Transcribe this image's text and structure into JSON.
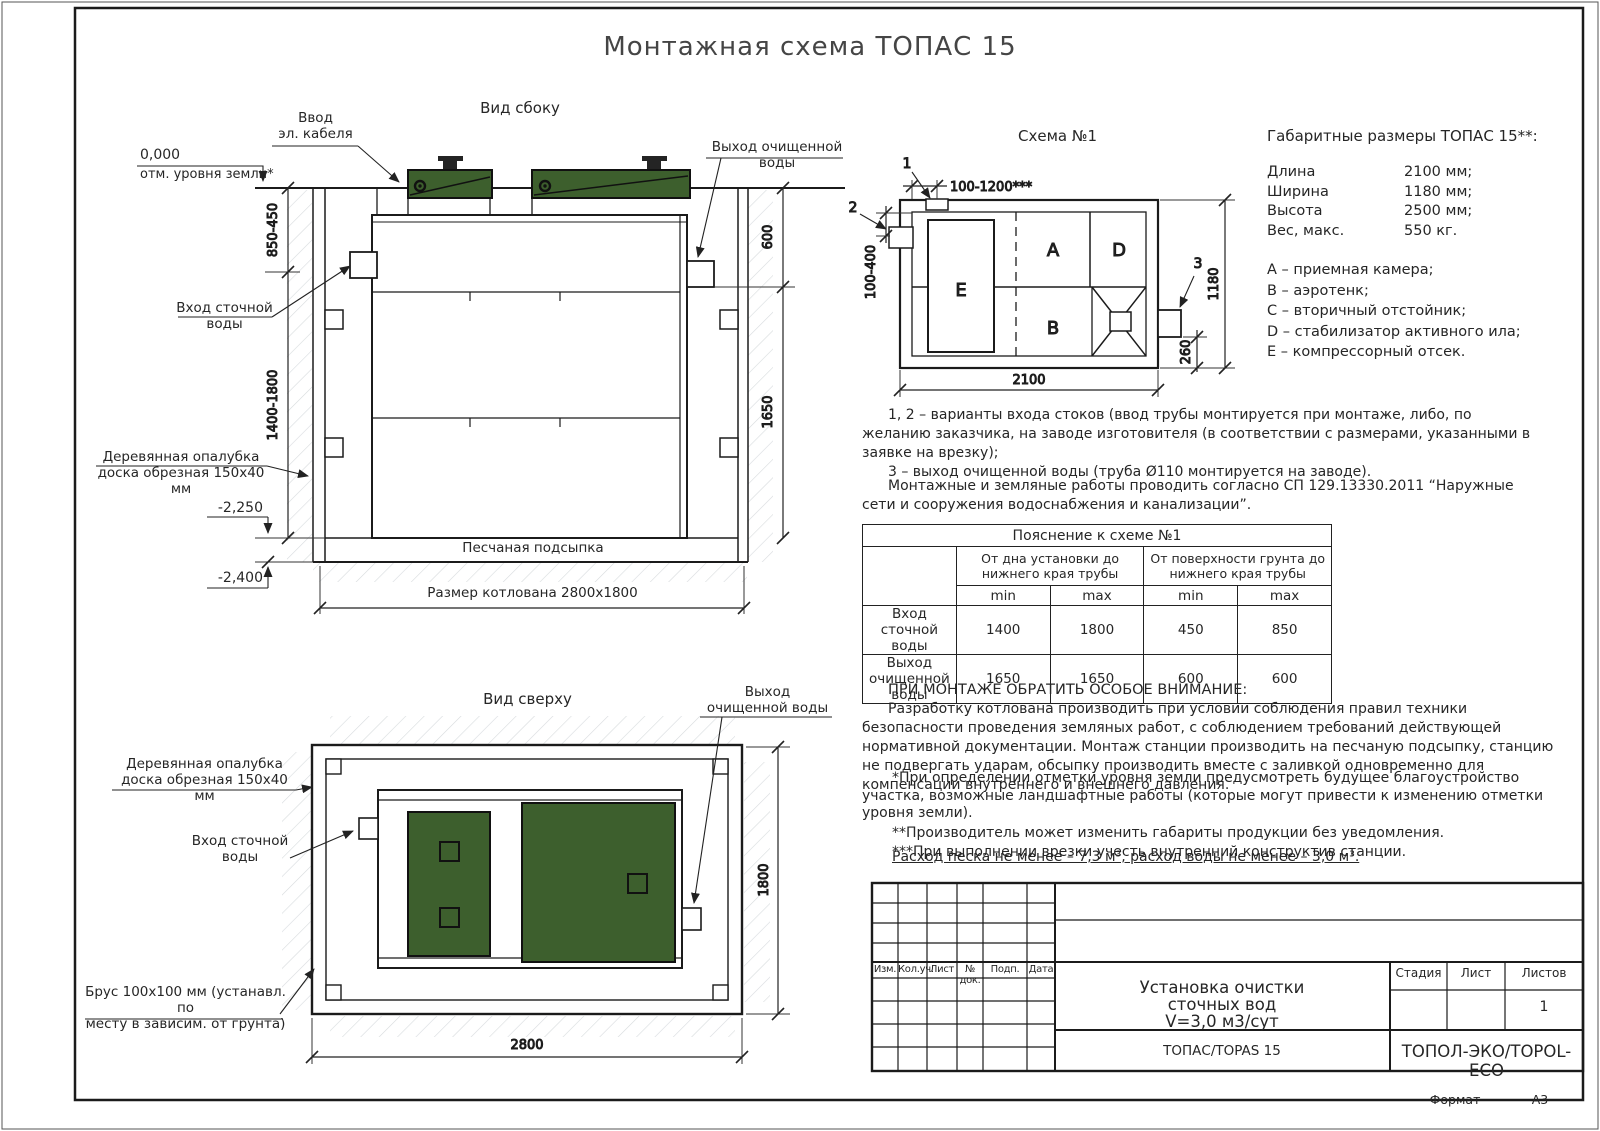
{
  "page": {
    "title": "Монтажная схема ТОПАС 15",
    "format_label": "Формат",
    "format_value": "А3"
  },
  "side_view": {
    "heading": "Вид сбоку",
    "cable_label": "Ввод\nэл. кабеля",
    "zero_mark": "0,000",
    "zero_label": "отм. уровня земли*",
    "inlet_label": "Вход сточной\nводы",
    "outlet_label": "Выход очищенной\nводы",
    "formwork_label": "Деревянная опалубка\nдоска обрезная 150х40 мм",
    "sand_label": "Песчаная подсыпка",
    "pit_label": "Размер котлована 2800х1800",
    "lvl_minus_2250": "-2,250",
    "lvl_minus_2400": "-2,400",
    "dim_850_450": "850-450",
    "dim_1400_1800": "1400-1800",
    "dim_600": "600",
    "dim_1650": "1650"
  },
  "scheme": {
    "heading": "Схема №1",
    "mark_1": "1",
    "mark_2": "2",
    "mark_3": "3",
    "comp_a": "A",
    "comp_b": "B",
    "comp_d": "D",
    "comp_e": "E",
    "dim_top": "100-1200***",
    "dim_left": "100-400",
    "dim_width": "2100",
    "dim_height": "1180",
    "dim_outlet": "260"
  },
  "overall": {
    "heading": "Габаритные размеры ТОПАС 15**:",
    "rows": [
      {
        "label": "Длина",
        "value": "2100 мм;"
      },
      {
        "label": "Ширина",
        "value": "1180 мм;"
      },
      {
        "label": "Высота",
        "value": "2500 мм;"
      },
      {
        "label": "Вес, макс.",
        "value": "550 кг."
      }
    ],
    "legend": [
      "А – приемная камера;",
      "В – аэротенк;",
      "С – вторичный отстойник;",
      "D – стабилизатор активного ила;",
      "Е – компрессорный отсек."
    ]
  },
  "notes": {
    "variants_1": "1, 2 – варианты входа стоков (ввод трубы монтируется при монтаже, либо, по желанию заказчика, на заводе изготовителя (в соответствии с размерами, указанными в заявке на врезку);",
    "variants_2": "3 – выход очищенной воды (труба Ø110 монтируется на заводе).",
    "works": "Монтажные и земляные работы проводить согласно СП 129.13330.2011 “Наружные сети и сооружения водоснабжения и канализации”."
  },
  "table": {
    "title": "Пояснение к схеме №1",
    "group1": "От дна установки до нижнего края трубы",
    "group2": "От поверхности грунта до нижнего края трубы",
    "min1": "min",
    "max1": "max",
    "min2": "min",
    "max2": "max",
    "rows": [
      {
        "label": "Вход сточной воды",
        "c1": "1400",
        "c2": "1800",
        "c3": "450",
        "c4": "850"
      },
      {
        "label": "Выход очищенной воды",
        "c1": "1650",
        "c2": "1650",
        "c3": "600",
        "c4": "600"
      }
    ]
  },
  "attention": {
    "heading": "ПРИ МОНТАЖЕ ОБРАТИТЬ ОСОБОЕ ВНИМАНИЕ:",
    "body": "Разработку котлована производить при условии соблюдения правил техники безопасности проведения земляных работ, с соблюдением требований действующей нормативной документации. Монтаж станции производить на песчаную подсыпку, станцию не подвергать ударам, обсыпку производить вместе с заливкой одновременно для компенсации внутреннего и внешнего давления."
  },
  "footnotes": {
    "fn1": "*При определении отметки уровня земли предусмотреть будущее благоустройство участка, возможные ландшафтные работы (которые могут привести к изменению отметки уровня земли).",
    "fn2": "**Производитель может изменить габариты продукции без уведомления.",
    "fn3": "***При выполнении врезки учесть внутренний конструктив станции.",
    "consumption": "Расход песка не менее – 7,3 м³, расход воды не менее – 3,0 м³."
  },
  "top_view": {
    "heading": "Вид сверху",
    "outlet_label": "Выход\nочищенной воды",
    "formwork_label": "Деревянная опалубка\nдоска обрезная 150х40 мм",
    "inlet_label": "Вход сточной\nводы",
    "beam_label": "Брус 100х100 мм (устанавл. по\nместу в зависим. от грунта)",
    "dim_height": "1800",
    "dim_width": "2800"
  },
  "title_block": {
    "cols": [
      "Изм.",
      "Кол.уч.",
      "Лист",
      "№ док.",
      "Подп.",
      "Дата"
    ],
    "doc_line1": "Установка очистки",
    "doc_line2": "сточных вод",
    "doc_line3": "V=3,0 м3/сут",
    "stage": "Стадия",
    "sheet": "Лист",
    "sheets": "Листов",
    "sheets_value": "1",
    "product": "ТОПАС/TOPAS 15",
    "company": "ТОПОЛ-ЭКО/TOPOL-ECO"
  },
  "colors": {
    "lid_green": "#3d5f2d",
    "line_dark": "#1c1c1c"
  }
}
